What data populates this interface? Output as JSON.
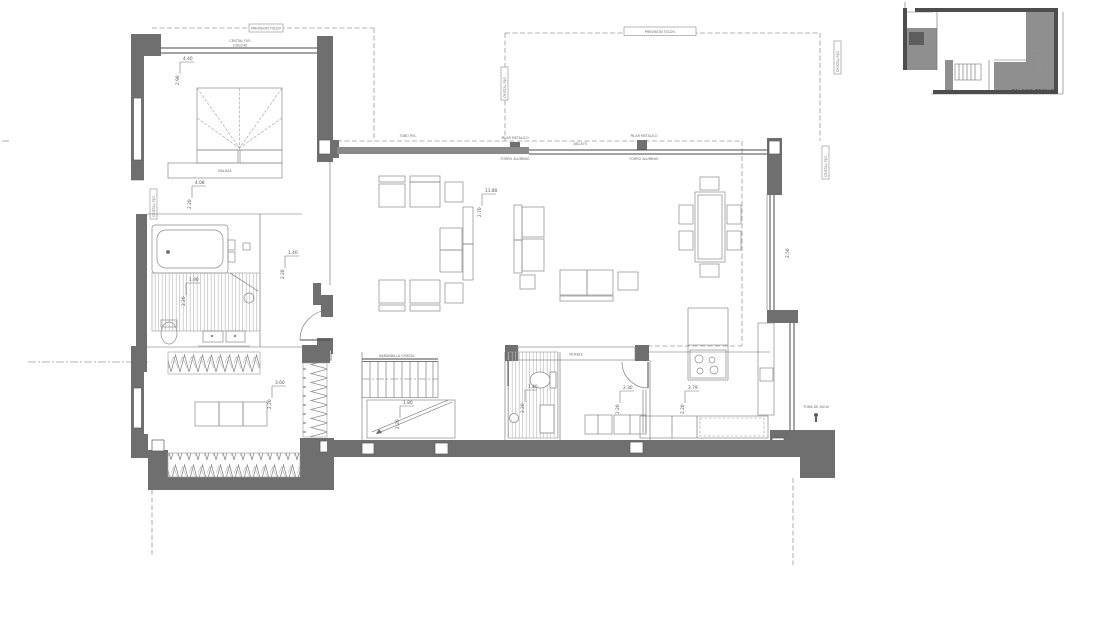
{
  "plan": {
    "annotations": {
      "baldas": "BALDAS",
      "pilar_metalico_a": "PILAR METALICO",
      "forro_aluminio_a": "FORRO ALUMINIO",
      "pilar_metalico_b": "PILAR METALICO",
      "forro_aluminio_b": "FORRO ALUMINIO",
      "span_dimension": "280.875",
      "tubo_pvc": "TUBO PVC",
      "prevision_toldo_a": "PREVISION TOLDO",
      "prevision_toldo_b": "PREVISION TOLDO",
      "cristal_fijo": "CRISTAL FIJO",
      "cristal_fijo_size": "230x240",
      "barandilla_cristal": "BARANDILLA CRISTAL",
      "mueble": "MUEBLE",
      "toma_de_agua": "TOMA DE AGUA"
    },
    "dimensions": [
      {
        "name": "dormitorio-principal",
        "w": "4.40",
        "h": "2.90"
      },
      {
        "name": "pasillo-baldas",
        "w": "4.08",
        "h": "2.20"
      },
      {
        "name": "bano-principal",
        "w": "1.90",
        "h": "2.20"
      },
      {
        "name": "distribuidor",
        "w": "1.40",
        "h": "2.20"
      },
      {
        "name": "vestidor",
        "w": "3.60",
        "h": "2.20"
      },
      {
        "name": "salon-comedor",
        "w": "11.80",
        "h": "2.70"
      },
      {
        "name": "escalera",
        "w": "1.80",
        "h": "2.20"
      },
      {
        "name": "aseo",
        "w": "1.40",
        "h": "2.20"
      },
      {
        "name": "dormitorio-2",
        "w": "2.30",
        "h": "2.20"
      },
      {
        "name": "cocina",
        "w": "3.79",
        "h": "2.20"
      },
      {
        "name": "fachada-este",
        "w": "2.50",
        "h": ""
      }
    ],
    "inset": {
      "label": "FALSOS TECHOS"
    },
    "colors": {
      "wall": "#6f6f6f",
      "line": "#4a4a4a",
      "furniture": "#8a8a8a",
      "dashed": "#9a9a9a",
      "shade": "#8f8f8f",
      "background": "#ffffff"
    }
  }
}
